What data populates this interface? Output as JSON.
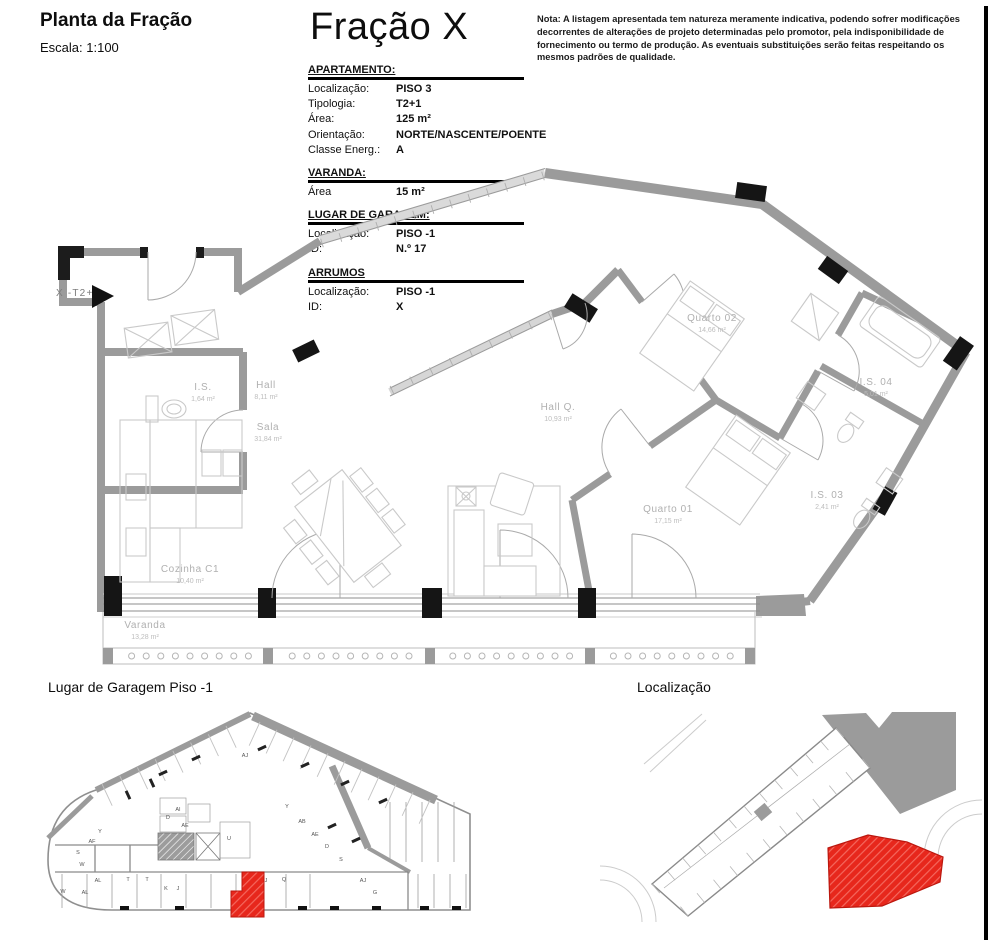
{
  "header": {
    "title": "Planta da Fração",
    "scale": "Escala: 1:100",
    "fraction_title": "Fração X",
    "note": "Nota: A listagem apresentada tem natureza meramente indicativa, podendo sofrer modificações decorrentes de alterações de projeto determinadas pelo promotor, pela indisponibilidade de fornecimento ou termo de produção. As eventuais substituições serão feitas respeitando os mesmos padrões de qualidade."
  },
  "info_table": {
    "sections": [
      {
        "title": "APARTAMENTO:",
        "rows": [
          [
            "Localização:",
            "PISO 3"
          ],
          [
            "Tipologia:",
            "T2+1"
          ],
          [
            "Área:",
            "125 m²"
          ],
          [
            "Orientação:",
            "NORTE/NASCENTE/POENTE"
          ],
          [
            "Classe Energ.:",
            "A"
          ]
        ]
      },
      {
        "title": "VARANDA:",
        "rows": [
          [
            "Área",
            "15 m²"
          ]
        ]
      },
      {
        "title": "LUGAR DE GARAGEM:",
        "rows": [
          [
            "Localização:",
            "PISO -1"
          ],
          [
            "ID:",
            "N.º 17"
          ]
        ]
      },
      {
        "title": "ARRUMOS",
        "rows": [
          [
            "Localização:",
            "PISO -1"
          ],
          [
            "ID:",
            "X"
          ]
        ]
      }
    ]
  },
  "floor_plan": {
    "unit_marker": "X -T2+1",
    "rooms": [
      {
        "name": "I.S.",
        "area": "1,64 m²",
        "x": 203,
        "y": 390
      },
      {
        "name": "Hall",
        "area": "8,11 m²",
        "x": 266,
        "y": 388
      },
      {
        "name": "Sala",
        "area": "31,84 m²",
        "x": 268,
        "y": 430
      },
      {
        "name": "Cozinha C1",
        "area": "10,40 m²",
        "x": 190,
        "y": 572
      },
      {
        "name": "Varanda",
        "area": "13,28 m²",
        "x": 145,
        "y": 628
      },
      {
        "name": "Hall Q.",
        "area": "10,93 m²",
        "x": 558,
        "y": 410
      },
      {
        "name": "Quarto 02",
        "area": "14,66 m²",
        "x": 712,
        "y": 321
      },
      {
        "name": "Quarto 01",
        "area": "17,15 m²",
        "x": 668,
        "y": 512
      },
      {
        "name": "I.S. 04",
        "area": "5,01 m²",
        "x": 876,
        "y": 385
      },
      {
        "name": "I.S. 03",
        "area": "2,41 m²",
        "x": 827,
        "y": 498
      }
    ]
  },
  "garage_plan": {
    "title": "Lugar de Garagem Piso -1",
    "bay_labels": [
      {
        "t": "AJ",
        "x": 245,
        "y": 757
      },
      {
        "t": "Y",
        "x": 287,
        "y": 808
      },
      {
        "t": "AB",
        "x": 302,
        "y": 823
      },
      {
        "t": "AE",
        "x": 315,
        "y": 836
      },
      {
        "t": "D",
        "x": 327,
        "y": 848
      },
      {
        "t": "S",
        "x": 341,
        "y": 861
      },
      {
        "t": "AJ",
        "x": 363,
        "y": 882
      },
      {
        "t": "G",
        "x": 375,
        "y": 894
      },
      {
        "t": "AF",
        "x": 92,
        "y": 843
      },
      {
        "t": "Y",
        "x": 100,
        "y": 833
      },
      {
        "t": "S",
        "x": 78,
        "y": 854
      },
      {
        "t": "W",
        "x": 82,
        "y": 866
      },
      {
        "t": "W",
        "x": 63,
        "y": 893
      },
      {
        "t": "AL",
        "x": 98,
        "y": 882
      },
      {
        "t": "AL",
        "x": 85,
        "y": 894
      },
      {
        "t": "T",
        "x": 128,
        "y": 881
      },
      {
        "t": "T",
        "x": 147,
        "y": 881
      },
      {
        "t": "K",
        "x": 166,
        "y": 890
      },
      {
        "t": "J",
        "x": 178,
        "y": 890
      },
      {
        "t": "D",
        "x": 168,
        "y": 819
      },
      {
        "t": "AI",
        "x": 178,
        "y": 811
      },
      {
        "t": "AE",
        "x": 185,
        "y": 827
      },
      {
        "t": "U",
        "x": 229,
        "y": 840
      },
      {
        "t": "J",
        "x": 266,
        "y": 882
      },
      {
        "t": "Q",
        "x": 284,
        "y": 881
      }
    ]
  },
  "location_plan": {
    "title": "Localização"
  },
  "colors": {
    "wall_gray": "#9b9b9b",
    "furniture_gray": "#c9c9c9",
    "label_gray": "#b0b0b0",
    "highlight_red": "#e7271c",
    "border_black": "#000000"
  }
}
